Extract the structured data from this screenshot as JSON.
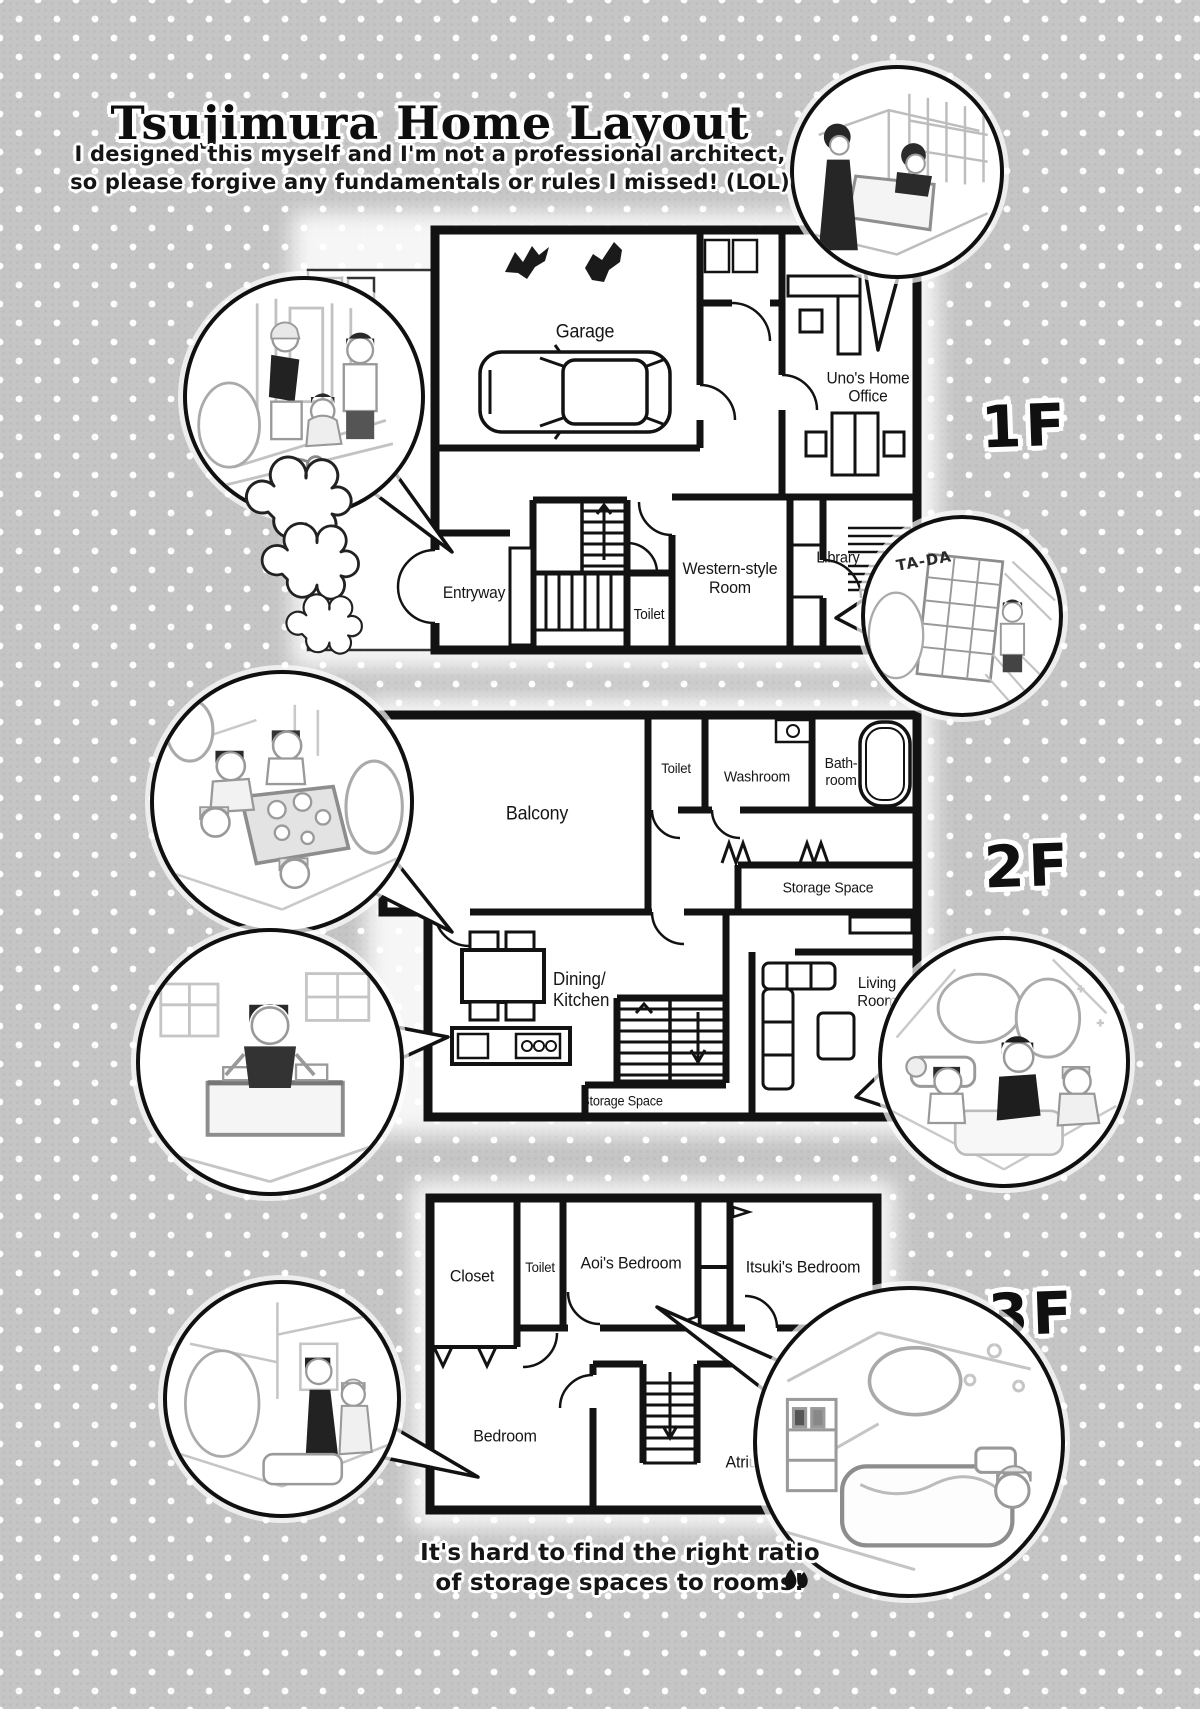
{
  "header": {
    "title": "Tsujimura Home Layout",
    "subtitle1": "I designed this myself and I'm not a professional architect,",
    "subtitle2": "so please forgive any fundamentals or rules I missed! (LOL)"
  },
  "floor1": {
    "label": "1F",
    "rooms": {
      "garage": "Garage",
      "office": "Uno's Home Office",
      "entryway": "Entryway",
      "toilet": "Toilet",
      "western": "Western-style Room",
      "library": "Library"
    }
  },
  "floor2": {
    "label": "2F",
    "rooms": {
      "balcony": "Balcony",
      "toilet": "Toilet",
      "washroom": "Washroom",
      "bathroom": "Bath-room",
      "storage_upper": "Storage Space",
      "dining_line1": "Dining/",
      "dining_line2": "Kitchen",
      "living": "Living Room",
      "storage_lower": "Storage Space"
    }
  },
  "floor3": {
    "label": "3F",
    "rooms": {
      "closet": "Closet",
      "toilet": "Toilet",
      "aoi": "Aoi's Bedroom",
      "itsuki": "Itsuki's Bedroom",
      "bedroom": "Bedroom",
      "atrium": "Atrium"
    }
  },
  "insets": {
    "library_sfx": "TA-DA"
  },
  "footer": {
    "line1": "It's hard to find the right ratio",
    "line2": "of storage spaces to rooms!"
  }
}
